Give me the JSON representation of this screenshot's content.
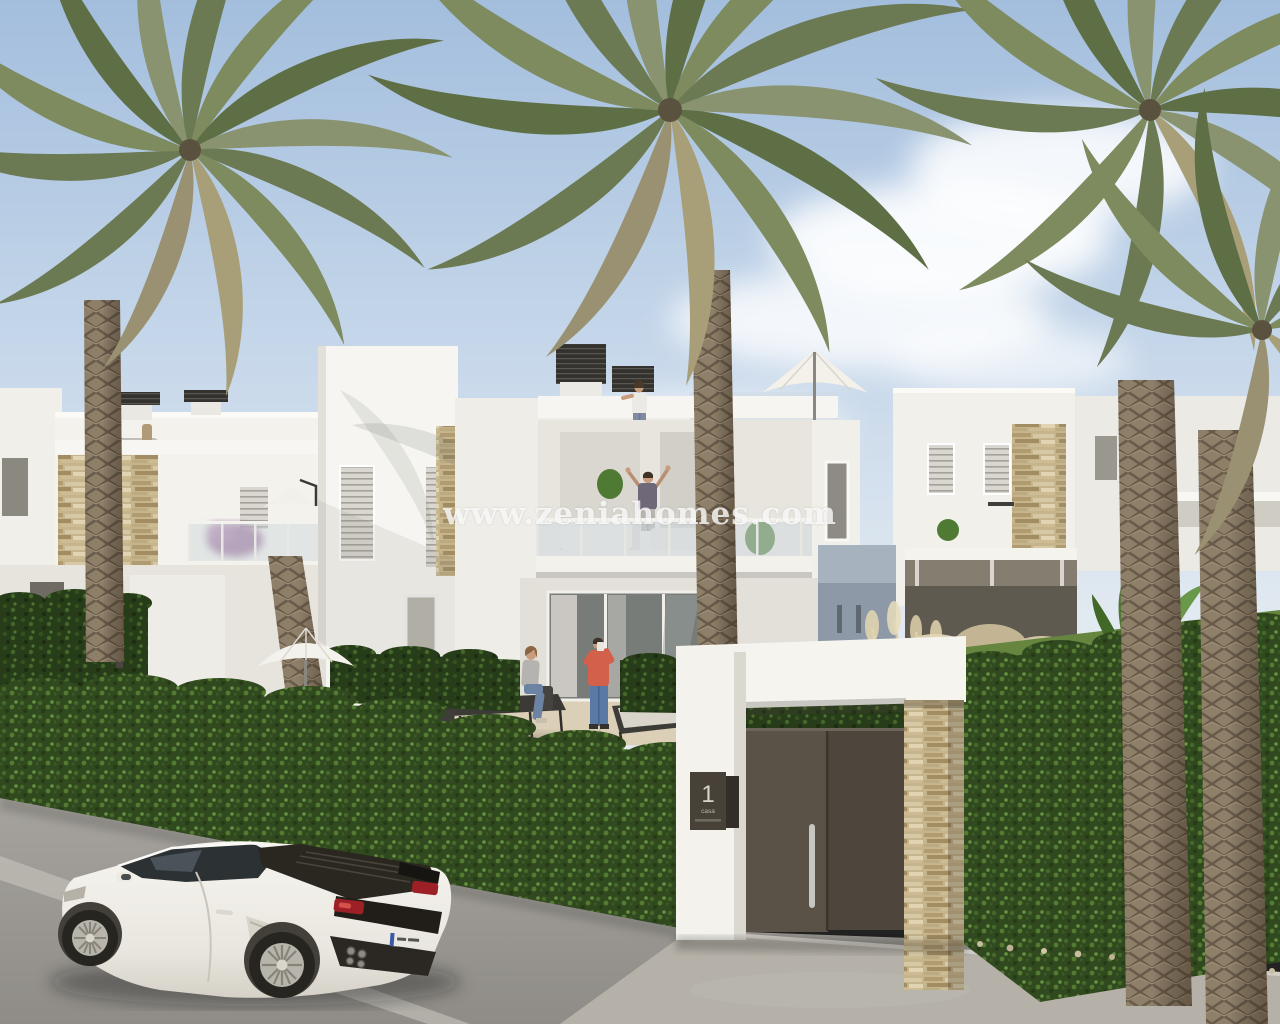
{
  "scene": {
    "type": "3d-architectural-render",
    "description": "New-build white Mediterranean townhouses with roof terraces, palm trees, green hedges, a dark entrance gate with number plaque, and a white sports car parked on the street",
    "watermark": "www.zeniahomes.com",
    "gate_sign": {
      "number": "1",
      "label": "casa"
    },
    "palette": {
      "sky_blue": "#a8c2e0",
      "building_white": "#f4f3ef",
      "hedge_green": "#31491f",
      "palm_frond_green": "#74845a",
      "palm_trunk_brown": "#8e7f69",
      "stone_beige": "#c6b48c",
      "gate_door_brown": "#54493e",
      "road_gray": "#9d9a95",
      "car_white": "#f0eee8",
      "taillight_red": "#9c2026"
    },
    "objects": [
      "date palm trees",
      "white townhouses with roof terraces",
      "roof terrace parasols",
      "residents on terraces",
      "outdoor dining set",
      "sun loungers",
      "green hedges",
      "dark entrance gate with number plaque",
      "natural stone pillars and wall cladding",
      "white sports car on street"
    ]
  }
}
